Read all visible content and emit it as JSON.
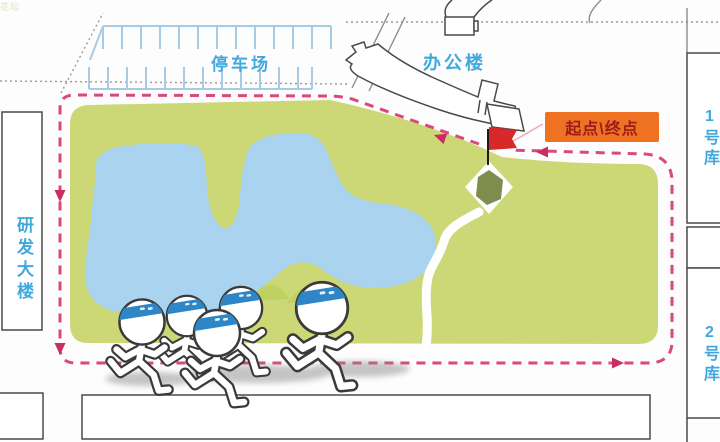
{
  "map": {
    "labels": {
      "parking_lot": "停车场",
      "office_building": "办公楼",
      "rd_building": "研发大楼",
      "warehouse_1": "1号库",
      "warehouse_2": "2号库",
      "flower_bed": "花坛",
      "start_finish": "起点\\终点"
    },
    "route": {
      "style": "dashed-loop",
      "direction": "counterclockwise",
      "arrows": 5
    },
    "runners": {
      "count": 5,
      "headband_color": "#2e86c7"
    },
    "colors": {
      "field-green": "#ccd876",
      "lake-blue": "#a9d3ef",
      "route-pink": "#d9497c",
      "route-arrow": "#c92e60",
      "badge-bg": "#ee7222",
      "badge-text": "#9c1c1c",
      "label-blue": "#41a8dc",
      "parking-blue": "#a6cbe7",
      "outline-gray": "#4a4a4a",
      "headband-blue": "#2e86c7",
      "flag-red": "#d7282a",
      "flowerbed-olive": "#7e8d4e"
    }
  }
}
